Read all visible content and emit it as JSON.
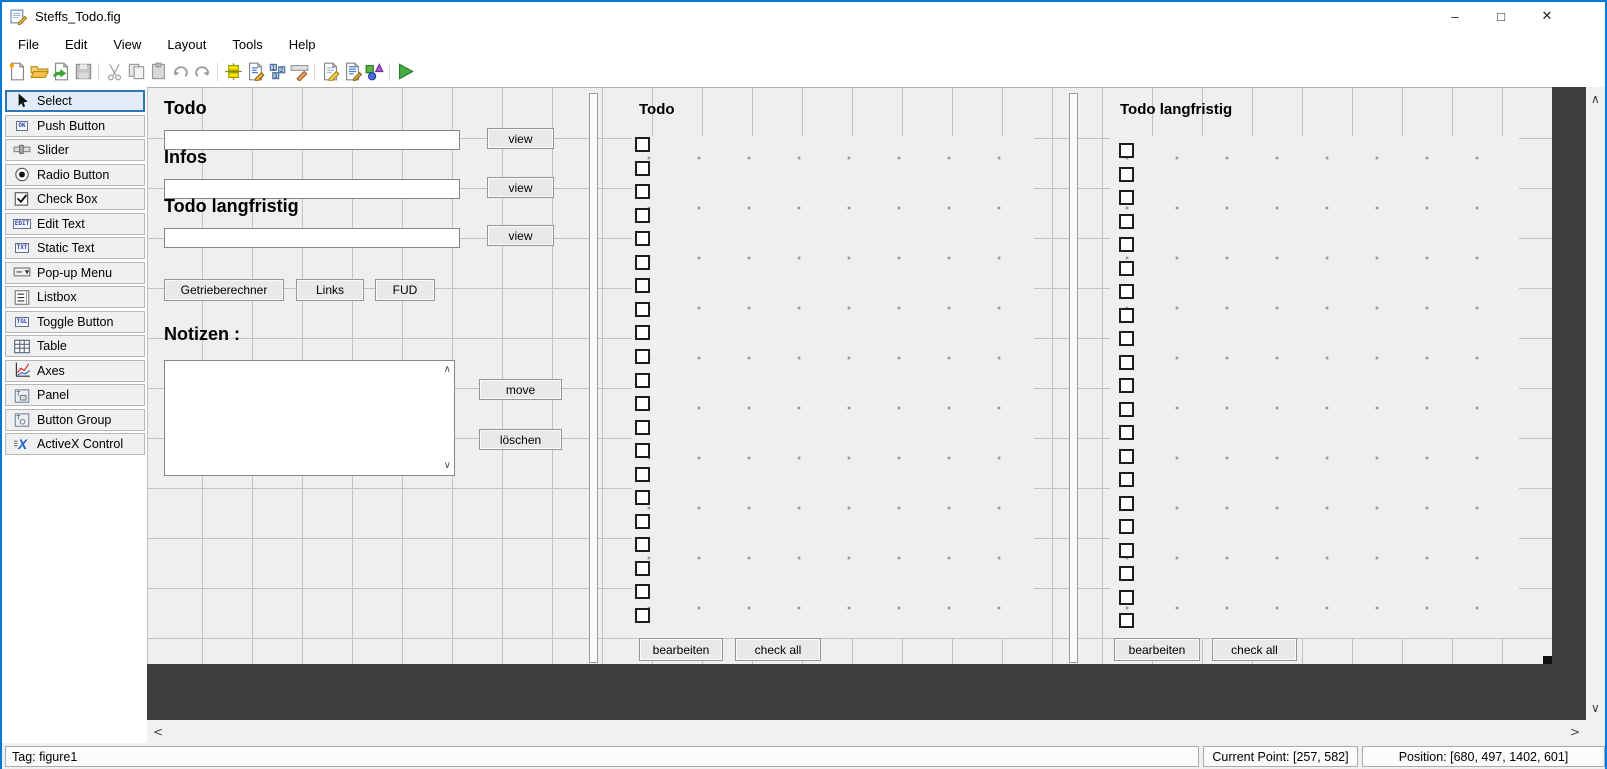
{
  "window": {
    "title": "Steffs_Todo.fig",
    "controls": {
      "minimize": "–",
      "maximize": "□",
      "close": "✕"
    }
  },
  "menubar": {
    "items": [
      "File",
      "Edit",
      "View",
      "Layout",
      "Tools",
      "Help"
    ]
  },
  "toolbar": {
    "items": [
      {
        "name": "new-figure-icon",
        "enabled": true
      },
      {
        "name": "open-figure-icon",
        "enabled": true
      },
      {
        "name": "export-icon",
        "enabled": true
      },
      {
        "name": "save-icon",
        "enabled": false
      },
      {
        "separator": true
      },
      {
        "name": "cut-icon",
        "enabled": false
      },
      {
        "name": "copy-icon",
        "enabled": false
      },
      {
        "name": "paste-icon",
        "enabled": false
      },
      {
        "name": "undo-icon",
        "enabled": false
      },
      {
        "name": "redo-icon",
        "enabled": false
      },
      {
        "separator": true
      },
      {
        "name": "align-objects-icon",
        "enabled": true
      },
      {
        "name": "menu-editor-icon",
        "enabled": true
      },
      {
        "name": "tab-order-editor-icon",
        "enabled": true
      },
      {
        "name": "toolbar-editor-icon",
        "enabled": true
      },
      {
        "separator": true
      },
      {
        "name": "editor-icon",
        "enabled": true
      },
      {
        "name": "property-inspector-icon",
        "enabled": true
      },
      {
        "name": "object-browser-icon",
        "enabled": true
      },
      {
        "separator": true
      },
      {
        "name": "run-icon",
        "enabled": true
      }
    ]
  },
  "palette": {
    "selected_index": 0,
    "items": [
      {
        "label": "Select",
        "icon": "cursor-icon"
      },
      {
        "label": "Push Button",
        "icon": "push-button-icon",
        "badge": "OK"
      },
      {
        "label": "Slider",
        "icon": "slider-icon"
      },
      {
        "label": "Radio Button",
        "icon": "radio-button-icon"
      },
      {
        "label": "Check Box",
        "icon": "check-box-icon"
      },
      {
        "label": "Edit Text",
        "icon": "edit-text-icon",
        "badge": "EDIT"
      },
      {
        "label": "Static Text",
        "icon": "static-text-icon",
        "badge": "TXT"
      },
      {
        "label": "Pop-up Menu",
        "icon": "popup-menu-icon"
      },
      {
        "label": "Listbox",
        "icon": "listbox-icon"
      },
      {
        "label": "Toggle Button",
        "icon": "toggle-button-icon",
        "badge": "TGL"
      },
      {
        "label": "Table",
        "icon": "table-icon"
      },
      {
        "label": "Axes",
        "icon": "axes-icon"
      },
      {
        "label": "Panel",
        "icon": "panel-icon"
      },
      {
        "label": "Button Group",
        "icon": "button-group-icon"
      },
      {
        "label": "ActiveX Control",
        "icon": "activex-icon"
      }
    ]
  },
  "canvas": {
    "left": {
      "rows": [
        {
          "label": "Todo",
          "button": "view"
        },
        {
          "label": "Infos",
          "button": "view"
        },
        {
          "label": "Todo langfristig",
          "button": "view"
        }
      ],
      "misc_buttons": [
        "Getrieberechner",
        "Links",
        "FUD"
      ],
      "notes_label": "Notizen :",
      "move_label": "move",
      "delete_label": "löschen"
    },
    "panels": {
      "todo": {
        "title": "Todo",
        "checkbox_count": 21,
        "edit_label": "bearbeiten",
        "check_all_label": "check all"
      },
      "todo_long": {
        "title": "Todo langfristig",
        "checkbox_count": 21,
        "edit_label": "bearbeiten",
        "check_all_label": "check all"
      }
    },
    "grid_spacing_px": 50
  },
  "scrollbars": {
    "up": "∧",
    "down": "∨",
    "left": "<",
    "right": ">"
  },
  "statusbar": {
    "tag": "Tag: figure1",
    "current_point": "Current Point:  [257, 582]",
    "position": "Position: [680, 497, 1402, 601]"
  },
  "colors": {
    "accent": "#0079d8",
    "canvas_bg": "#efeff0",
    "out_of_figure": "#3e3e40",
    "grid_line": "#c2c2c4",
    "palette_selected_border": "#2f76b5"
  }
}
